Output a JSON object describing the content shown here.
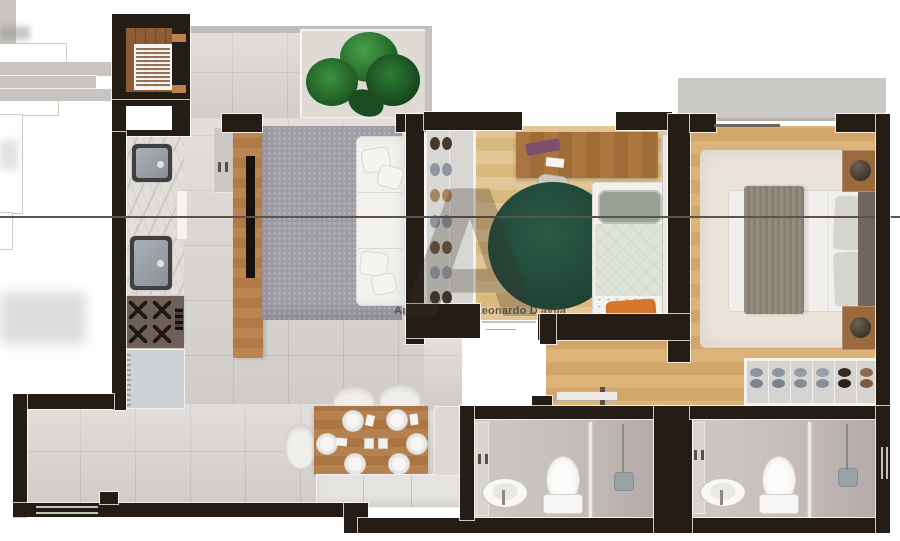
{
  "meta": {
    "description": "Top-down 3D rendered architectural floor plan of a two-bedroom apartment",
    "canvas": {
      "width": 900,
      "height": 541
    }
  },
  "watermark": {
    "credit": "André Alves ® Leonardo D'avila",
    "sub_mark": "es",
    "logo_letter": "A"
  },
  "palette": {
    "wall": "#241d16",
    "trim_white": "#f6f5f3",
    "tile_floor": "#d8d4d0",
    "wood_floor_light": "#e0c293",
    "wood_floor_warm": "#d7ac70",
    "wood_furniture": "#b07b4b",
    "living_rug": "#9f9ca4",
    "bedroom_round_rug_green": "#234c3c",
    "master_rug": "#e9e3da",
    "accent_orange_cushion": "#d8772b",
    "plant_green": "#2e7d32",
    "balcony_slab": "#cac9c4",
    "bath_floor": "#c6c0bb"
  },
  "rooms": [
    {
      "name": "service-balcony",
      "furniture": [
        "wood deck",
        "drying rack"
      ]
    },
    {
      "name": "kitchen",
      "furniture": [
        "sink",
        "second sink",
        "dishwasher",
        "cooktop",
        "refrigerator",
        "tall cabinet"
      ]
    },
    {
      "name": "living-room",
      "furniture": [
        "tv panel with tv",
        "shag rug",
        "sofa with cushions",
        "terrace with plant"
      ]
    },
    {
      "name": "dining-area",
      "furniture": [
        "wood table with six place settings",
        "chairs",
        "bench"
      ]
    },
    {
      "name": "bedroom-2",
      "furniture": [
        "shoe wardrobe",
        "desk with laptop",
        "desk chair",
        "round green rug",
        "single bed",
        "orange cushion"
      ]
    },
    {
      "name": "hallway",
      "furniture": [
        "open door leaf"
      ]
    },
    {
      "name": "master-bedroom",
      "furniture": [
        "double bed",
        "headboard",
        "two nightstands with lamps",
        "area rug",
        "shoe closet",
        "private balcony"
      ]
    },
    {
      "name": "bathroom-1",
      "furniture": [
        "vanity sink",
        "toilet",
        "glass shower"
      ]
    },
    {
      "name": "bathroom-2",
      "furniture": [
        "vanity sink",
        "toilet",
        "glass shower"
      ]
    }
  ]
}
